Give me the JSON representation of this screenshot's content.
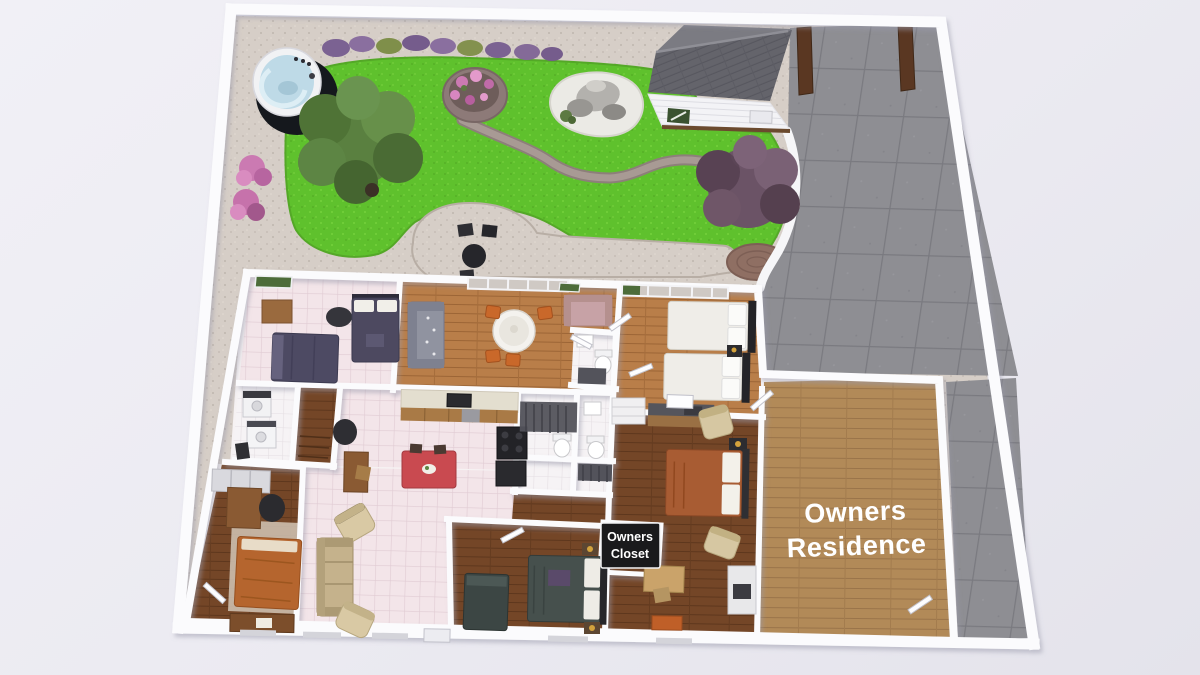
{
  "scene": {
    "type": "3d-floor-plan-render",
    "labels": {
      "owners_residence": {
        "line1": "Owners",
        "line2": "Residence"
      },
      "owners_closet": {
        "line1": "Owners",
        "line2": "Closet"
      }
    },
    "colors": {
      "background": "#ebeaf1",
      "wall": "#fbfbfd",
      "gravel": "#d6cec7",
      "lawn": "#5fc12d",
      "driveway": "#8e8e93",
      "path": "#a89a94",
      "wood_warm": "#b97e49",
      "wood_dark": "#744627",
      "wood_tan": "#b28a58",
      "tile_pink": "#f3e5e9",
      "tile_white": "#f6f3f5",
      "water": "#bedae7",
      "roof": "#64646b",
      "shed_door_green": "#3a5230",
      "gate_brown": "#5a3722",
      "tree_green": "#5a8040",
      "tree_purple": "#6b5366",
      "flower_pink": "#cb7ab2",
      "red_table": "#c94a50",
      "orange_chair": "#c9682a",
      "label_bg": "#1a1a1c",
      "label_text": "#ffffff"
    }
  }
}
